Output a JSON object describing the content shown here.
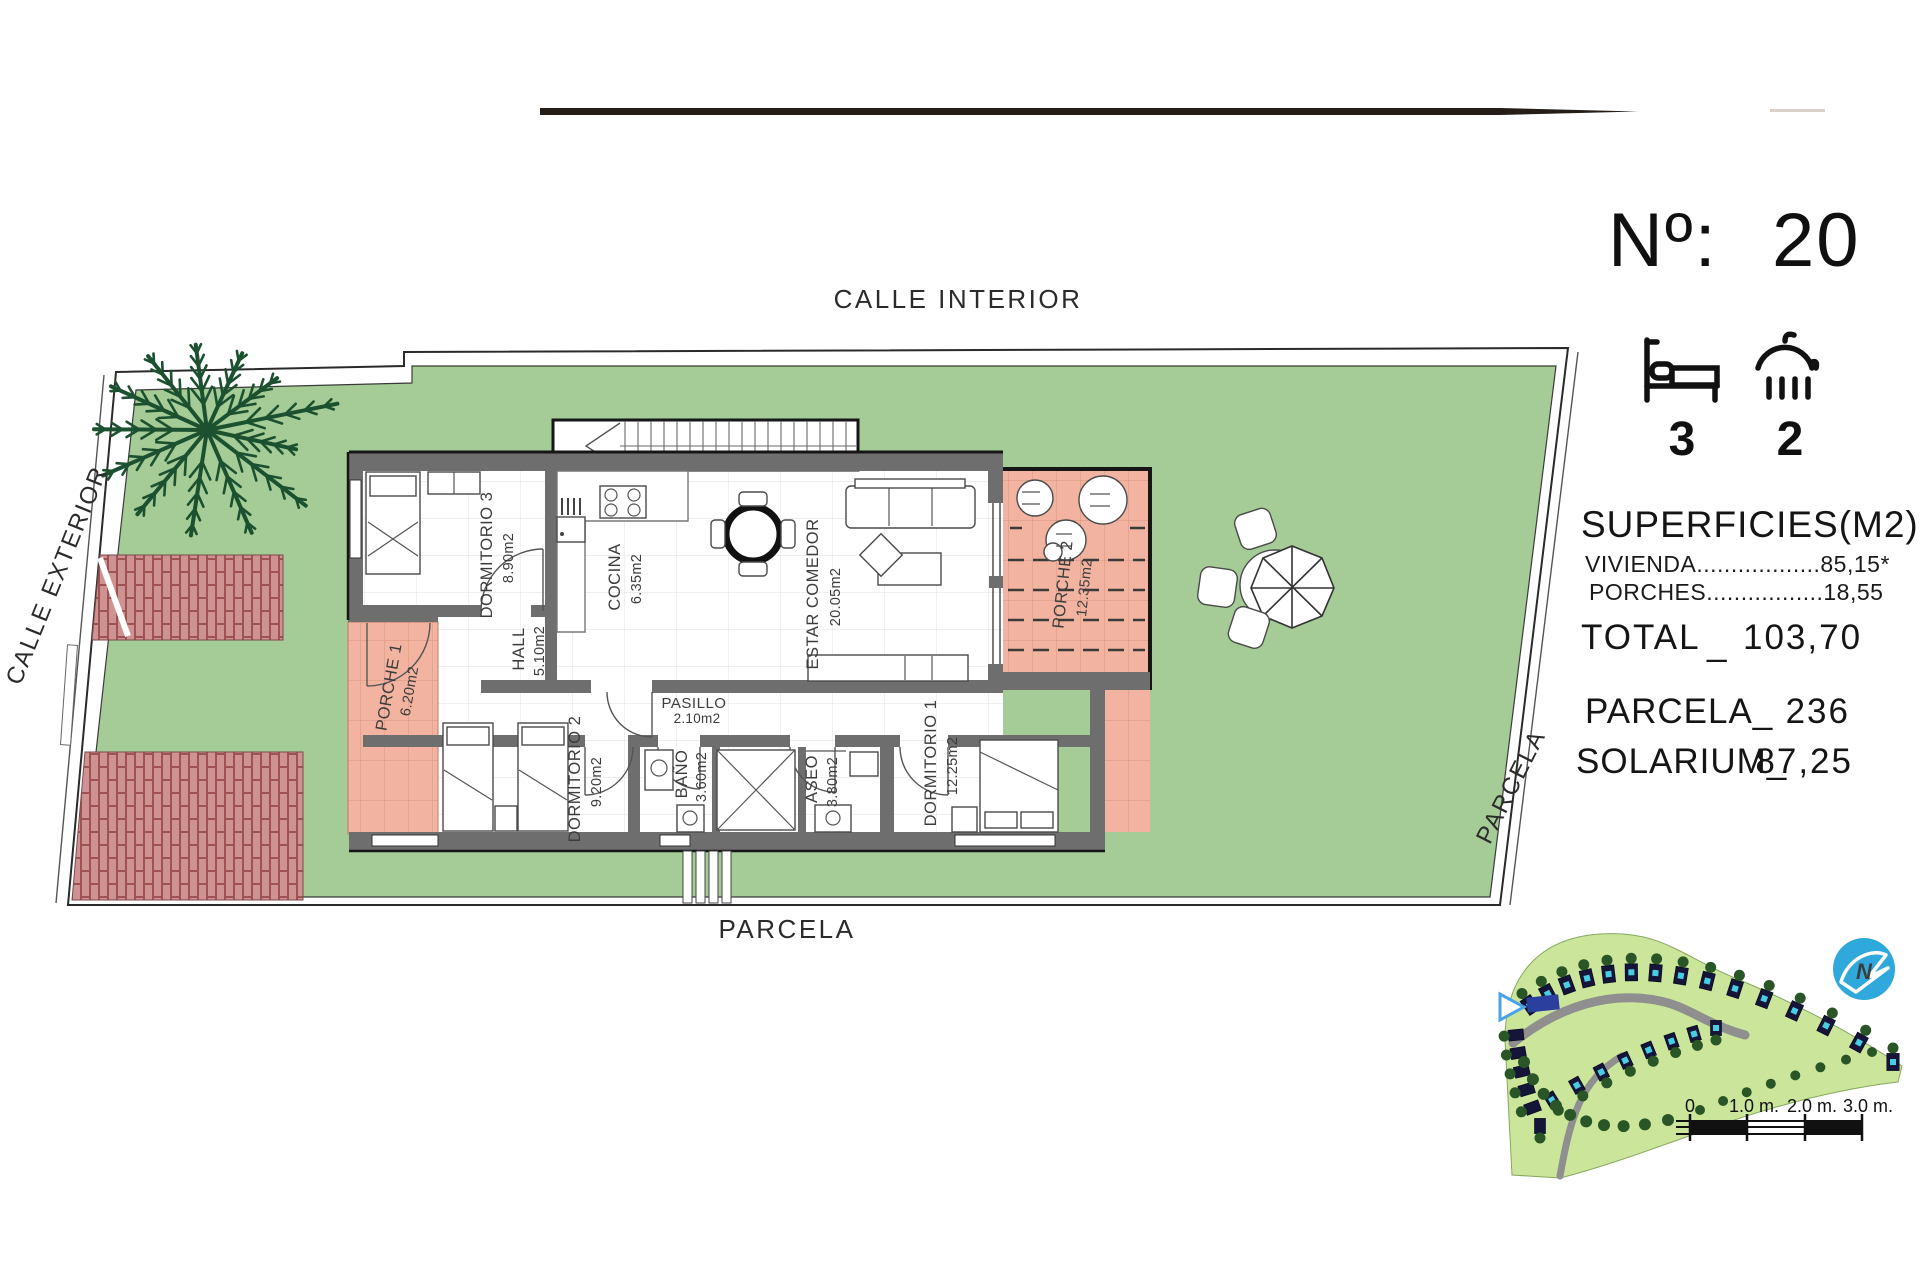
{
  "title": {
    "number_label": "Nº:",
    "number_value": "20"
  },
  "features": {
    "bedrooms": "3",
    "bathrooms": "2"
  },
  "surfaces": {
    "title": "SUPERFICIES(M2)",
    "vivienda_line": "VIVIENDA..................85,15*",
    "porches_line": "PORCHES.................18,55",
    "total_label": "TOTAL",
    "total_sep": "_",
    "total_value": "103,70",
    "parcela_label": "PARCELA_",
    "parcela_value": "236",
    "solarium_label": "SOLARIUM_",
    "solarium_value": "87,25"
  },
  "streets": {
    "top": "CALLE INTERIOR",
    "left": "CALLE EXTERIOR",
    "right": "PARCELA",
    "bottom": "PARCELA"
  },
  "rooms": [
    {
      "name": "DORMITORIO 3",
      "area": "8.90m2"
    },
    {
      "name": "COCINA",
      "area": "6.35m2"
    },
    {
      "name": "HALL",
      "area": "5.10m2"
    },
    {
      "name": "PASILLO",
      "area": "2.10m2"
    },
    {
      "name": "ESTAR COMEDOR",
      "area": "20.05m2"
    },
    {
      "name": "PORCHE 1",
      "area": "6.20m2"
    },
    {
      "name": "PORCHE 2",
      "area": "12.35m2"
    },
    {
      "name": "DORMITORIO 2",
      "area": "9.20m2"
    },
    {
      "name": "BAÑO",
      "area": "3.60m2"
    },
    {
      "name": "ASEO",
      "area": "3.80m2"
    },
    {
      "name": "DORMITORIO 1",
      "area": "12.25m2"
    }
  ],
  "scale_bar": {
    "t0": "0",
    "t1": "1.0 m.",
    "t2": "2.0 m.",
    "t3": "3.0 m."
  },
  "icons": {
    "bed": "bed-icon",
    "shower": "shower-icon",
    "north": "north-arrow-icon",
    "pointer": "plot-pointer-icon"
  },
  "colors": {
    "grass_green": "#a5cb96",
    "porch_salmon": "#f2b4a0",
    "brick_red": "#cd9090",
    "brick_joint": "#a05757",
    "wall_gray": "#6e6e6e",
    "outline_black": "#161616",
    "site_green": "#cbe69b",
    "pool_cyan": "#49cde2",
    "plot_dark": "#15153a",
    "tree_green": "#2a5526",
    "road_gray": "#8f8f8f",
    "compass_blue": "#2fa8dc",
    "highlight_blue": "#2b3f9e"
  }
}
